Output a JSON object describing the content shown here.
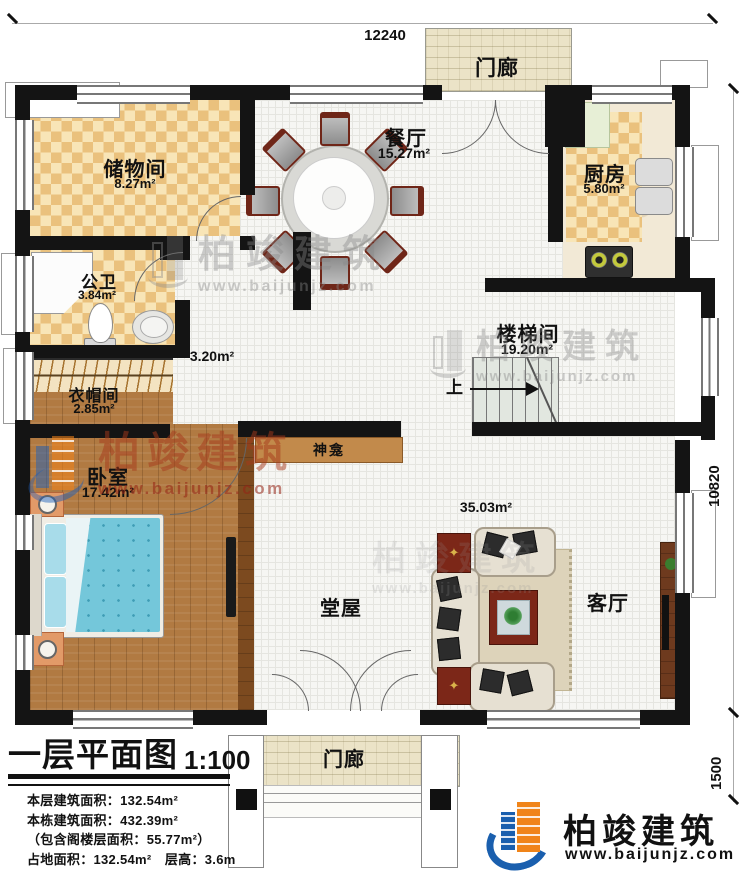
{
  "title": {
    "main": "一层平面图",
    "scale": "1:100"
  },
  "dimensions": {
    "width_top": "12240",
    "height_right": "10820",
    "porch_depth": "1500"
  },
  "rooms": {
    "storage": {
      "name": "储物间",
      "area": "8.27m²"
    },
    "dining": {
      "name": "餐厅",
      "area": "15.27m²"
    },
    "kitchen": {
      "name": "厨房",
      "area": "5.80m²"
    },
    "bathroom": {
      "name": "公卫",
      "area": "3.84m²"
    },
    "corridor": {
      "area": "3.20m²"
    },
    "cloakroom": {
      "name": "衣帽间",
      "area": "2.85m²"
    },
    "bedroom": {
      "name": "卧室",
      "area": "17.42m²"
    },
    "stairwell": {
      "name": "楼梯间",
      "area": "19.20m²",
      "up_label": "上"
    },
    "hall": {
      "name": "堂屋"
    },
    "living": {
      "name": "客厅",
      "area": "35.03m²"
    },
    "shrine": {
      "name": "神龛"
    },
    "porch_top": {
      "name": "门廊"
    },
    "porch_bottom": {
      "name": "门廊"
    }
  },
  "info": {
    "line1": "本层建筑面积：132.54m²",
    "line2": "本栋建筑面积：432.39m²",
    "line3": "（包含阁楼层面积：55.77m²）",
    "line4": "占地面积：132.54m²　层高：3.6m"
  },
  "brand": {
    "name": "柏竣建筑",
    "url": "www.baijunjz.com"
  },
  "watermark": {
    "name": "柏竣建筑",
    "url": "www.baijunjz.com"
  },
  "colors": {
    "accent_orange": "#f08419",
    "accent_blue": "#1a5fae",
    "wall": "#141414"
  }
}
